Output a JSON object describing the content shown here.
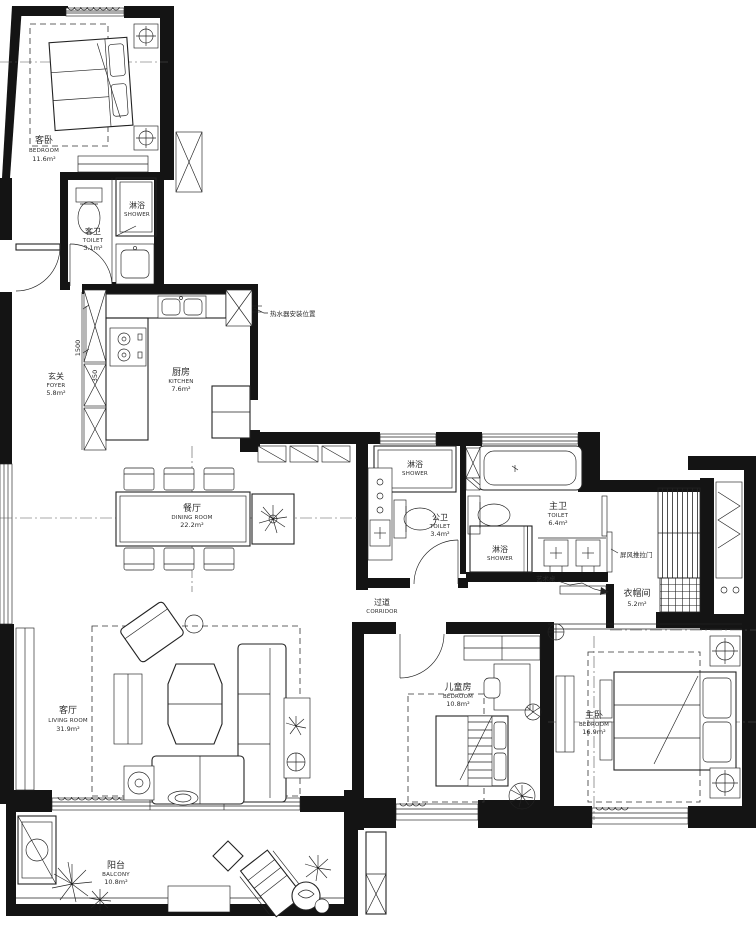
{
  "rooms": {
    "guest_bedroom": {
      "name_cn": "客卧",
      "name_en": "BEDROOM",
      "area": "11.6m²"
    },
    "guest_toilet": {
      "name_cn": "客卫",
      "name_en": "TOILET",
      "area": "3.1m²"
    },
    "shower": {
      "name_cn": "淋浴",
      "name_en": "SHOWER"
    },
    "foyer": {
      "name_cn": "玄关",
      "name_en": "FOYER",
      "area": "5.8m²"
    },
    "kitchen": {
      "name_cn": "厨房",
      "name_en": "KITCHEN",
      "area": "7.6m²"
    },
    "dining": {
      "name_cn": "餐厅",
      "name_en": "DINING ROOM",
      "area": "22.2m²"
    },
    "living": {
      "name_cn": "客厅",
      "name_en": "LIVING ROOM",
      "area": "31.9m²"
    },
    "corridor": {
      "name_cn": "过道",
      "name_en": "CORRIDOR"
    },
    "public_toilet": {
      "name_cn": "公卫",
      "name_en": "TOILET",
      "area": "3.4m²"
    },
    "master_toilet": {
      "name_cn": "主卫",
      "name_en": "TOILET",
      "area": "6.4m²"
    },
    "cloakroom": {
      "name_cn": "衣帽间",
      "area": "5.2m²"
    },
    "children_room": {
      "name_cn": "儿童房",
      "name_en": "BEDROOM",
      "area": "10.8m²"
    },
    "master_bedroom": {
      "name_cn": "主卧",
      "name_en": "BEDROOM",
      "area": "16.9m²"
    },
    "balcony": {
      "name_cn": "阳台",
      "name_en": "BALCONY",
      "area": "10.8m²"
    }
  },
  "notes": {
    "water_heater": "热水器安装位置",
    "screen_door": "屏风推拉门",
    "art_table": "艺术桌"
  },
  "dims": {
    "d1500": "1500",
    "d350": "350"
  },
  "colors": {
    "wall": "#141414",
    "line": "#222222",
    "text": "#2b2b2b",
    "background": "#ffffff"
  }
}
